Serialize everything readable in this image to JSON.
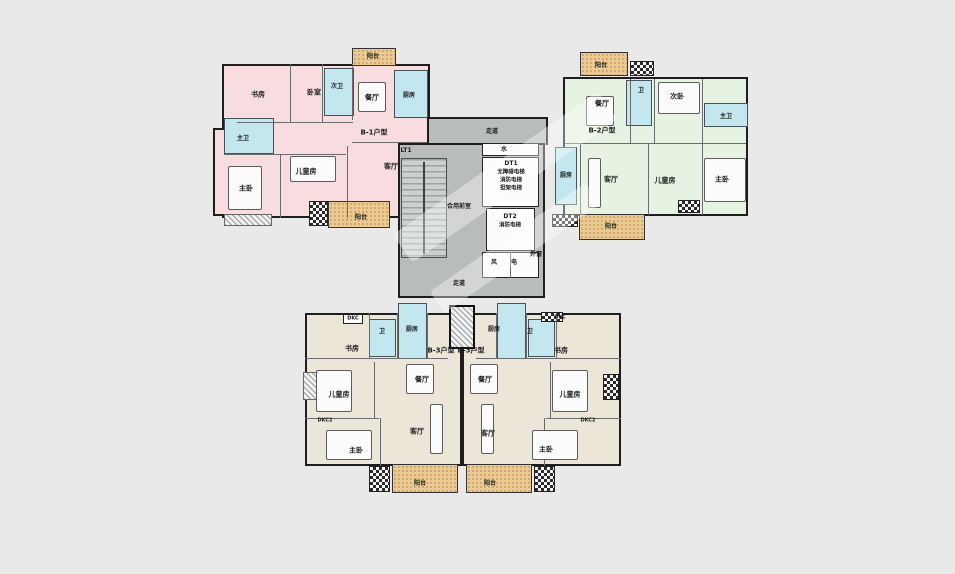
{
  "title": "residential-floor-plan",
  "colors": {
    "background": "#e9e9e9",
    "unit_b1": "#f7dce0",
    "unit_b2": "#e6f3e2",
    "unit_b3": "#ece6d9",
    "wet_room": "#c3e7ef",
    "balcony": "#eaca92",
    "core": "#b8bcbb",
    "wall": "#1e1e1e"
  },
  "units": [
    {
      "id": "B-1",
      "name": "B-1户型",
      "fill": "#f7dce0",
      "position": "top-left"
    },
    {
      "id": "B-2",
      "name": "B-2户型",
      "fill": "#e6f3e2",
      "position": "top-right"
    },
    {
      "id": "B-3",
      "name": "B-3户型",
      "fill": "#ece6d9",
      "position": "bottom-left"
    },
    {
      "id": "B-3",
      "name": "B-3户型",
      "fill": "#ece6d9",
      "position": "bottom-right"
    }
  ],
  "core": {
    "stair": "LT1",
    "elevators": [
      {
        "id": "DT1",
        "notes": [
          "无障碍电梯",
          "消防电梯",
          "担架电梯"
        ]
      },
      {
        "id": "DT2",
        "notes": [
          "消防电梯"
        ]
      }
    ],
    "rooms": [
      "走道",
      "合用前室",
      "水",
      "风",
      "电",
      "外窗",
      "走道"
    ]
  },
  "labels": [
    {
      "name": "b1-balcony-top-label",
      "text": "阳台",
      "x": 373,
      "y": 57,
      "fs": 6
    },
    {
      "name": "b1-study-label",
      "text": "书房",
      "x": 258,
      "y": 95,
      "fs": 7
    },
    {
      "name": "b1-bedroom-label",
      "text": "卧室",
      "x": 314,
      "y": 93,
      "fs": 7
    },
    {
      "name": "b1-bath2-label",
      "text": "次卫",
      "x": 337,
      "y": 87,
      "fs": 6
    },
    {
      "name": "b1-dining-label",
      "text": "餐厅",
      "x": 372,
      "y": 98,
      "fs": 7
    },
    {
      "name": "b1-kitchen-label",
      "text": "厨房",
      "x": 409,
      "y": 96,
      "fs": 6
    },
    {
      "name": "b1-type-label",
      "text": "B-1户型",
      "x": 374,
      "y": 133,
      "fs": 7
    },
    {
      "name": "b1-bath1-label",
      "text": "主卫",
      "x": 243,
      "y": 139,
      "fs": 6
    },
    {
      "name": "b1-master-label",
      "text": "主卧",
      "x": 246,
      "y": 189,
      "fs": 7
    },
    {
      "name": "b1-kids-label",
      "text": "儿童房",
      "x": 306,
      "y": 172,
      "fs": 7
    },
    {
      "name": "b1-living-label",
      "text": "客厅",
      "x": 391,
      "y": 167,
      "fs": 7
    },
    {
      "name": "b1-balcony-bottom-label",
      "text": "阳台",
      "x": 361,
      "y": 218,
      "fs": 6
    },
    {
      "name": "b2-balcony-top-label",
      "text": "阳台",
      "x": 601,
      "y": 66,
      "fs": 6
    },
    {
      "name": "b2-dining-label",
      "text": "餐厅",
      "x": 602,
      "y": 104,
      "fs": 7
    },
    {
      "name": "b2-bath2-label",
      "text": "卫",
      "x": 641,
      "y": 91,
      "fs": 6
    },
    {
      "name": "b2-bedroom2-label",
      "text": "次卧",
      "x": 677,
      "y": 97,
      "fs": 7
    },
    {
      "name": "b2-bath1-label",
      "text": "主卫",
      "x": 726,
      "y": 117,
      "fs": 6
    },
    {
      "name": "b2-type-label",
      "text": "B-2户型",
      "x": 602,
      "y": 131,
      "fs": 7
    },
    {
      "name": "b2-kitchen-label",
      "text": "厨房",
      "x": 566,
      "y": 176,
      "fs": 6
    },
    {
      "name": "b2-living-label",
      "text": "客厅",
      "x": 611,
      "y": 180,
      "fs": 7
    },
    {
      "name": "b2-kids-label",
      "text": "儿童房",
      "x": 665,
      "y": 181,
      "fs": 7
    },
    {
      "name": "b2-master-label",
      "text": "主卧",
      "x": 722,
      "y": 180,
      "fs": 7
    },
    {
      "name": "b2-balcony-bottom-label",
      "text": "阳台",
      "x": 611,
      "y": 227,
      "fs": 6
    },
    {
      "name": "core-corridor-top-label",
      "text": "走道",
      "x": 492,
      "y": 132,
      "fs": 6
    },
    {
      "name": "core-stair-label",
      "text": "LT1",
      "x": 406,
      "y": 151,
      "fs": 6
    },
    {
      "name": "core-water-label",
      "text": "水",
      "x": 504,
      "y": 150,
      "fs": 6
    },
    {
      "name": "elevator1-id-label",
      "text": "DT1",
      "x": 511,
      "y": 164,
      "fs": 6
    },
    {
      "name": "elevator1-note1-label",
      "text": "无障碍电梯",
      "x": 511,
      "y": 173,
      "fs": 5.5
    },
    {
      "name": "elevator1-note2-label",
      "text": "消防电梯",
      "x": 511,
      "y": 181,
      "fs": 5.5
    },
    {
      "name": "elevator1-note3-label",
      "text": "担架电梯",
      "x": 511,
      "y": 189,
      "fs": 5.5
    },
    {
      "name": "core-lobby-label",
      "text": "合用前室",
      "x": 459,
      "y": 207,
      "fs": 6
    },
    {
      "name": "elevator2-id-label",
      "text": "DT2",
      "x": 510,
      "y": 217,
      "fs": 6
    },
    {
      "name": "elevator2-note1-label",
      "text": "消防电梯",
      "x": 510,
      "y": 226,
      "fs": 5.5
    },
    {
      "name": "core-vent-label",
      "text": "风",
      "x": 494,
      "y": 263,
      "fs": 6
    },
    {
      "name": "core-elec-label",
      "text": "电",
      "x": 514,
      "y": 263,
      "fs": 6
    },
    {
      "name": "core-window-label",
      "text": "外窗",
      "x": 536,
      "y": 255,
      "fs": 6
    },
    {
      "name": "core-corridor-bottom-label",
      "text": "走道",
      "x": 459,
      "y": 284,
      "fs": 6
    },
    {
      "name": "b3l-ac-top-label",
      "text": "DKC",
      "x": 353,
      "y": 319,
      "fs": 5
    },
    {
      "name": "b3l-study-label",
      "text": "书房",
      "x": 352,
      "y": 349,
      "fs": 7
    },
    {
      "name": "b3l-bath-label",
      "text": "卫",
      "x": 382,
      "y": 332,
      "fs": 6
    },
    {
      "name": "b3l-kitchen-label",
      "text": "厨房",
      "x": 412,
      "y": 330,
      "fs": 6
    },
    {
      "name": "b3l-type-label",
      "text": "B-3户型",
      "x": 441,
      "y": 351,
      "fs": 7
    },
    {
      "name": "b3l-dining-label",
      "text": "餐厅",
      "x": 422,
      "y": 380,
      "fs": 7
    },
    {
      "name": "b3l-kids-label",
      "text": "儿童房",
      "x": 339,
      "y": 395,
      "fs": 7
    },
    {
      "name": "b3l-ac-side-label",
      "text": "DKC2",
      "x": 325,
      "y": 421,
      "fs": 5
    },
    {
      "name": "b3l-living-label",
      "text": "客厅",
      "x": 417,
      "y": 432,
      "fs": 7
    },
    {
      "name": "b3l-master-label",
      "text": "主卧",
      "x": 356,
      "y": 451,
      "fs": 7
    },
    {
      "name": "b3l-balcony-label",
      "text": "阳台",
      "x": 420,
      "y": 484,
      "fs": 6
    },
    {
      "name": "b3r-ac-top-label",
      "text": "DKC",
      "x": 560,
      "y": 318,
      "fs": 5
    },
    {
      "name": "b3r-kitchen-label",
      "text": "厨房",
      "x": 494,
      "y": 330,
      "fs": 6
    },
    {
      "name": "b3r-bath-label",
      "text": "卫",
      "x": 530,
      "y": 332,
      "fs": 6
    },
    {
      "name": "b3r-study-label",
      "text": "书房",
      "x": 561,
      "y": 351,
      "fs": 7
    },
    {
      "name": "b3r-type-label",
      "text": "B-3户型",
      "x": 471,
      "y": 351,
      "fs": 7
    },
    {
      "name": "b3r-dining-label",
      "text": "餐厅",
      "x": 485,
      "y": 380,
      "fs": 7
    },
    {
      "name": "b3r-kids-label",
      "text": "儿童房",
      "x": 570,
      "y": 395,
      "fs": 7
    },
    {
      "name": "b3r-ac-side-label",
      "text": "DKC2",
      "x": 588,
      "y": 421,
      "fs": 5
    },
    {
      "name": "b3r-living-label",
      "text": "客厅",
      "x": 488,
      "y": 434,
      "fs": 7
    },
    {
      "name": "b3r-master-label",
      "text": "主卧",
      "x": 546,
      "y": 450,
      "fs": 7
    },
    {
      "name": "b3r-balcony-label",
      "text": "阳台",
      "x": 490,
      "y": 484,
      "fs": 6
    }
  ]
}
